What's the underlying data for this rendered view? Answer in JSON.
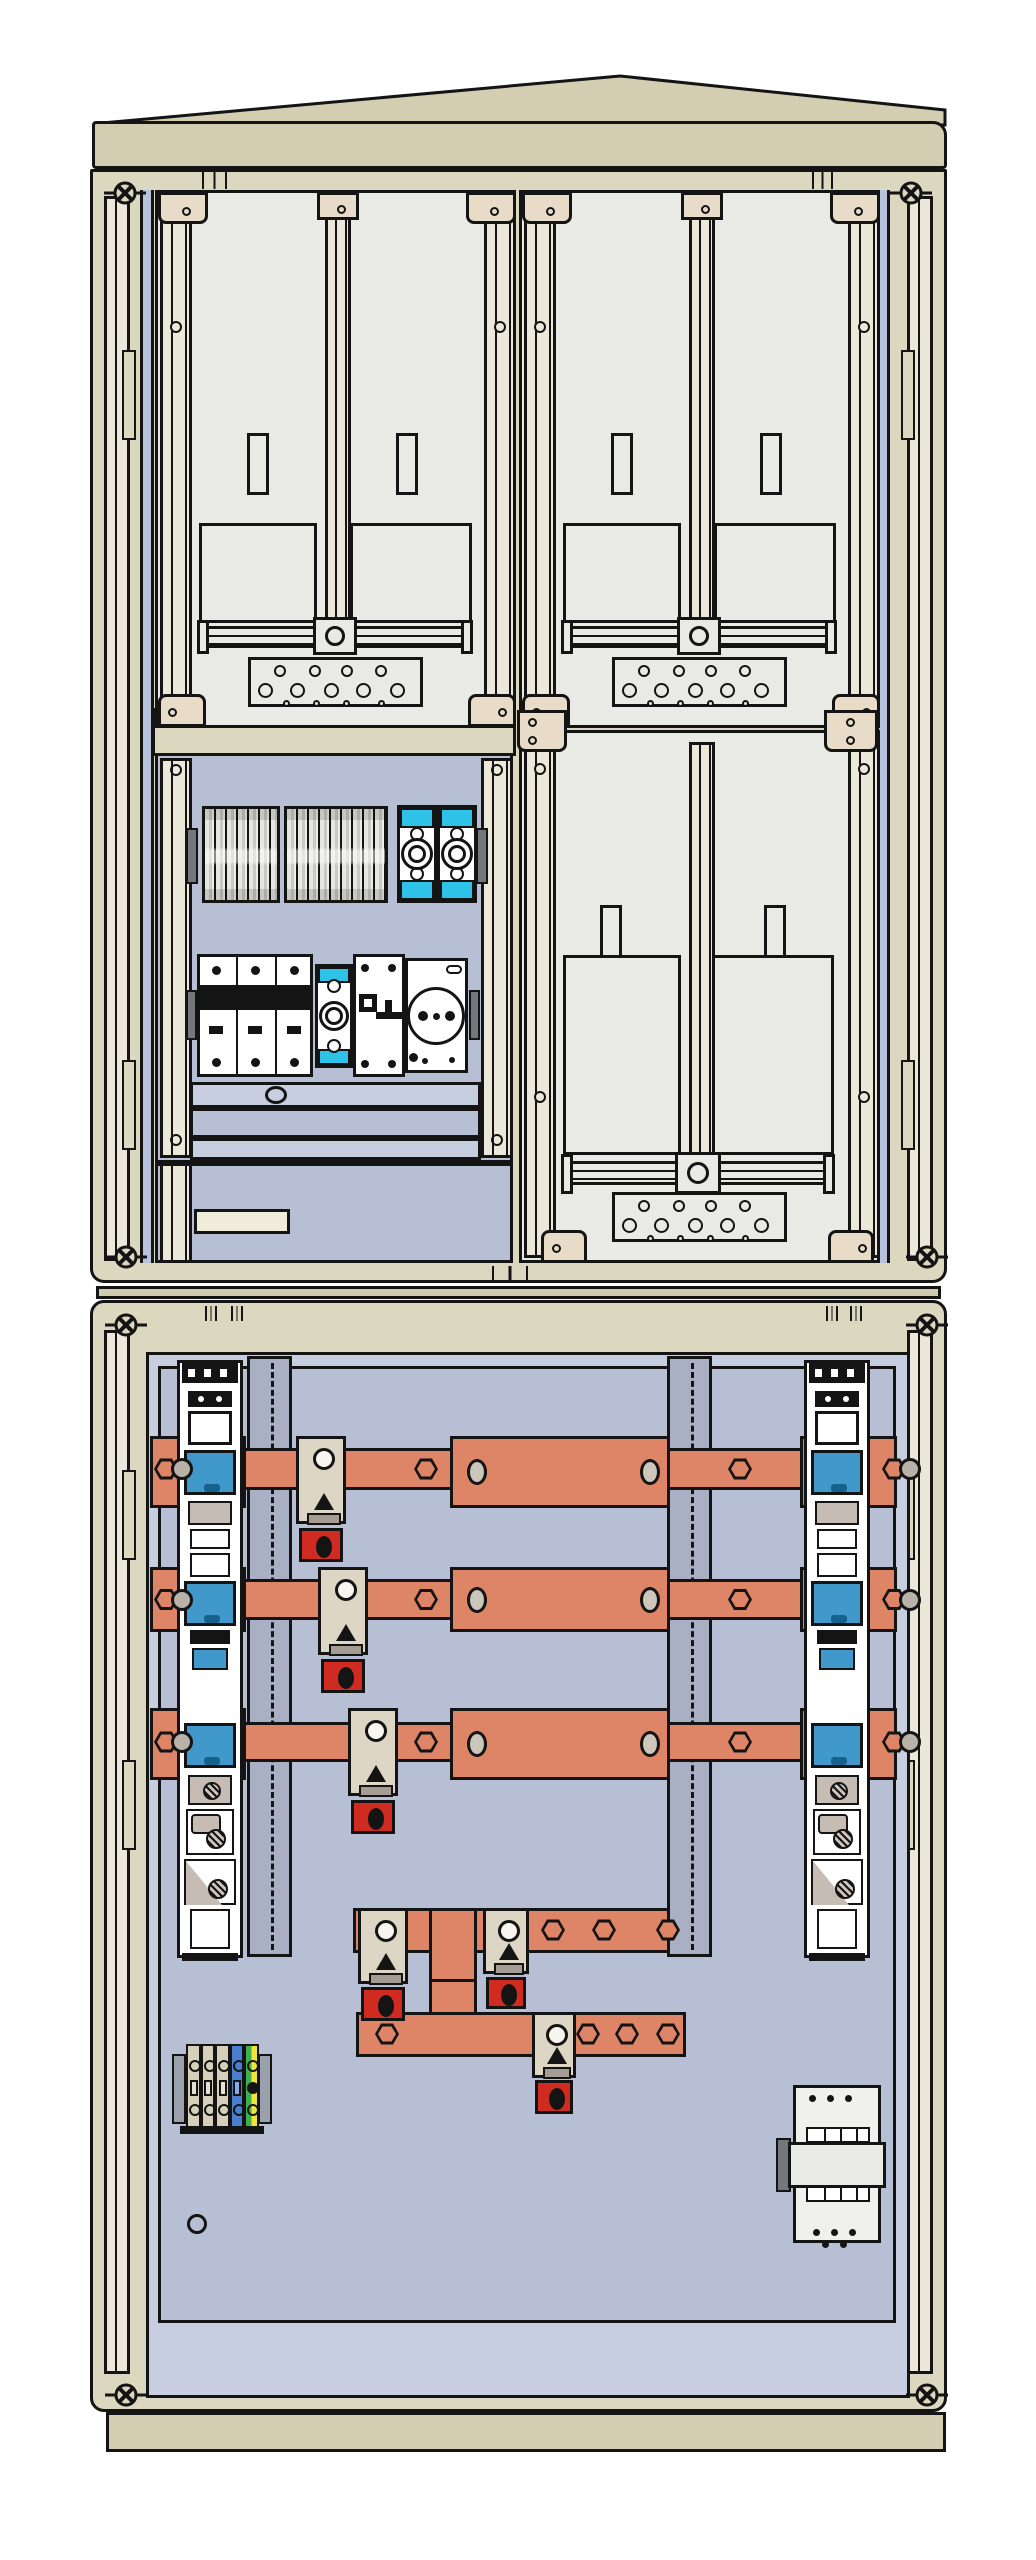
{
  "document": {
    "type": "technical-illustration",
    "subject": "outdoor cable distribution and meter cabinet, front view, doors open",
    "sections": [
      "upper enclosure with two meter fields, distribution device field and lower-right meter field",
      "lower enclosure with busbar system, NH fuse strips, terminal block and main switch"
    ]
  },
  "colors": {
    "ink": "#141414",
    "background": "#ffffff",
    "roof_beige": "#d3ceb2",
    "wall_beige": "#dcd8c0",
    "junction_beige": "#d0ccb0",
    "cream_rail": "#ece8d9",
    "bracket_cream": "#e8dcc9",
    "meter_panel": "#e9e9e5",
    "mounting_plate": "#b6bfd3",
    "door_inner": "#c6cedf",
    "cable_rail_gray": "#a9b0c4",
    "duct_light": "#c6cedf",
    "copper_busbar": "#dd8566",
    "oval_hole": "#cdc6bb",
    "nut_gray": "#b9b2a9",
    "fuse_blue": "#4198cb",
    "fuse_blue_dark": "#16628f",
    "cyan_band": "#2fc2e9",
    "clamp_beige": "#ddd6c4",
    "clamp_taupe": "#c7bcb4",
    "red_sleeve": "#cf2b20",
    "rail_end_gray": "#74787d",
    "terminal_beige": "#d6d0ba",
    "terminal_blue": "#4a7fd0",
    "terminal_green": "#3fae4e",
    "terminal_yellow": "#f0e437",
    "device_white": "#f0f0ed"
  },
  "meter_fields": [
    {
      "name": "meter-field-top-left",
      "panel": [
        155,
        190,
        361,
        538
      ],
      "rails": [
        [
          160,
          195,
          32,
          528
        ],
        [
          484,
          195,
          32,
          528
        ]
      ],
      "rail_screws": [
        [
          176,
          207
        ],
        [
          176,
          327
        ],
        [
          500,
          207
        ],
        [
          500,
          327
        ]
      ],
      "top_brackets": [
        [
          158,
          192,
          50,
          32
        ],
        [
          466,
          192,
          50,
          32
        ]
      ],
      "center_bar": [
        325,
        200,
        26,
        424
      ],
      "center_bracket": [
        317,
        192,
        42,
        28
      ],
      "slots": [
        [
          247,
          433
        ],
        [
          396,
          433
        ]
      ],
      "slot_size": [
        22,
        62
      ],
      "windows": [
        [
          199,
          523,
          118,
          100
        ],
        [
          350,
          523,
          122,
          100
        ]
      ],
      "hrail": {
        "bar": [
          199,
          626,
          274,
          22
        ],
        "caps": [
          [
            197,
            620,
            12,
            34
          ],
          [
            461,
            620,
            12,
            34
          ]
        ],
        "block": [
          313,
          617,
          44,
          38
        ],
        "circle": [
          335,
          636,
          10
        ]
      },
      "plate": [
        248,
        657
      ],
      "bottom_brackets": [
        [
          158,
          694,
          48,
          33
        ],
        [
          468,
          694,
          48,
          33
        ]
      ],
      "bottom_holes": [
        [
          172,
          712
        ],
        [
          502,
          712
        ]
      ]
    },
    {
      "name": "meter-field-top-right",
      "panel": [
        519,
        190,
        361,
        538
      ],
      "rails": [
        [
          524,
          195,
          32,
          528
        ],
        [
          848,
          195,
          32,
          528
        ]
      ],
      "rail_screws": [
        [
          540,
          207
        ],
        [
          540,
          327
        ],
        [
          864,
          207
        ],
        [
          864,
          327
        ]
      ],
      "top_brackets": [
        [
          522,
          192,
          50,
          32
        ],
        [
          830,
          192,
          50,
          32
        ]
      ],
      "center_bar": [
        689,
        200,
        26,
        424
      ],
      "center_bracket": [
        681,
        192,
        42,
        28
      ],
      "slots": [
        [
          611,
          433
        ],
        [
          760,
          433
        ]
      ],
      "slot_size": [
        22,
        62
      ],
      "windows": [
        [
          563,
          523,
          118,
          100
        ],
        [
          714,
          523,
          122,
          100
        ]
      ],
      "hrail": {
        "bar": [
          563,
          626,
          274,
          22
        ],
        "caps": [
          [
            561,
            620,
            12,
            34
          ],
          [
            825,
            620,
            12,
            34
          ]
        ],
        "block": [
          677,
          617,
          44,
          38
        ],
        "circle": [
          699,
          636,
          10
        ]
      },
      "plate": [
        612,
        657
      ],
      "bottom_brackets": [
        [
          522,
          694,
          48,
          33
        ],
        [
          832,
          694,
          48,
          33
        ]
      ],
      "bottom_holes": [
        [
          536,
          712
        ],
        [
          866,
          712
        ]
      ]
    },
    {
      "name": "meter-field-bottom-right",
      "panel": [
        519,
        730,
        361,
        533
      ],
      "rails": [
        [
          524,
          735,
          32,
          523
        ],
        [
          848,
          735,
          32,
          523
        ]
      ],
      "rail_screws": [
        [
          540,
          769
        ],
        [
          540,
          1097
        ],
        [
          864,
          769
        ],
        [
          864,
          1097
        ]
      ],
      "top_brackets": [
        [
          517,
          710,
          50,
          42
        ],
        [
          824,
          710,
          54,
          42
        ]
      ],
      "top_bracket_holes": [
        [
          532,
          722
        ],
        [
          532,
          740
        ],
        [
          850,
          722
        ],
        [
          850,
          740
        ]
      ],
      "center_bar": [
        689,
        742,
        26,
        416
      ],
      "center_bracket": null,
      "slots": [
        [
          600,
          905
        ],
        [
          764,
          905
        ]
      ],
      "slot_size": [
        22,
        62
      ],
      "windows": [
        [
          563,
          955,
          118,
          200
        ],
        [
          712,
          955,
          122,
          200
        ]
      ],
      "hrail": {
        "bar": [
          563,
          1161,
          272,
          24
        ],
        "caps": [
          [
            561,
            1154,
            12,
            40
          ],
          [
            823,
            1154,
            12,
            40
          ]
        ],
        "block": [
          675,
          1152,
          46,
          42
        ],
        "circle": [
          698,
          1173,
          11
        ]
      },
      "plate": [
        612,
        1192
      ],
      "bottom_brackets": [
        [
          541,
          1230,
          46,
          33
        ],
        [
          828,
          1230,
          46,
          33
        ]
      ],
      "bottom_holes": [
        [
          556,
          1248
        ],
        [
          862,
          1248
        ]
      ]
    }
  ],
  "perforated_plate": {
    "w": 175,
    "h": 50,
    "rows": [
      {
        "dy": 11,
        "r": 6,
        "xs": [
          29,
          64,
          96,
          130
        ]
      },
      {
        "dy": 30,
        "r": 7.5,
        "xs": [
          14,
          46,
          80,
          112,
          146
        ]
      },
      {
        "dy": 43,
        "r": 3.5,
        "xs": [
          35,
          65,
          95,
          130
        ]
      }
    ]
  },
  "busbars": {
    "span_x": [
      150,
      897
    ],
    "wide_x": [
      450,
      220
    ],
    "pad_left": [
      150,
      96
    ],
    "pad_right": [
      800,
      97
    ],
    "hex_x": [
      426,
      740
    ],
    "oval_x": [
      477,
      650
    ],
    "bars": [
      {
        "name": "busbar-L1",
        "wide_y": 1436,
        "wide_h": 72,
        "narrow_y": 1448,
        "narrow_h": 42,
        "clamp_x": 296
      },
      {
        "name": "busbar-L2",
        "wide_y": 1567,
        "wide_h": 65,
        "narrow_y": 1579,
        "narrow_h": 41,
        "clamp_x": 318
      },
      {
        "name": "busbar-L3",
        "wide_y": 1708,
        "wide_h": 72,
        "narrow_y": 1722,
        "narrow_h": 40,
        "clamp_x": 348
      }
    ]
  },
  "fuse_strips": {
    "xs": [
      177,
      804
    ],
    "w": 66,
    "y": 1360,
    "h": 598,
    "blue_windows_y": [
      87,
      218,
      360
    ],
    "names": [
      "nh-fuse-strip-left",
      "nh-fuse-strip-right"
    ]
  },
  "cable_rails": [
    [
      247,
      1356,
      45,
      601
    ],
    [
      667,
      1356,
      45,
      601
    ]
  ],
  "lower_assembly": {
    "upper_bar": [
      353,
      1908,
      333,
      45
    ],
    "vertical_bar": [
      429,
      1908,
      48,
      148
    ],
    "lower_bar": [
      356,
      2012,
      330,
      45
    ],
    "hexes_upper": [
      553,
      604,
      668
    ],
    "hexes_lower": [
      387,
      588,
      627,
      668
    ],
    "clamps": [
      {
        "x": 358,
        "w": 50,
        "top": 1908,
        "beigeH": 76,
        "redY": 1987,
        "redH": 34
      },
      {
        "x": 483,
        "w": 46,
        "top": 1908,
        "beigeH": 66,
        "redY": 1977,
        "redH": 32
      },
      {
        "x": 532,
        "w": 44,
        "top": 2012,
        "beigeH": 66,
        "redY": 2080,
        "redH": 34
      }
    ]
  },
  "terminal_block": {
    "x": 172,
    "y": 2042,
    "w": 100,
    "h": 92,
    "terminal_colors": [
      "beige",
      "beige",
      "beige",
      "blue",
      "green-yellow"
    ]
  },
  "main_switch_device": {
    "body": [
      793,
      2085,
      88,
      158
    ],
    "clip": [
      776,
      2138,
      15,
      54
    ],
    "mid_band": [
      788,
      2142,
      98,
      46
    ],
    "top_dots": [
      [
        812,
        2094
      ],
      [
        830,
        2094
      ],
      [
        848,
        2094
      ]
    ],
    "bottom_dots": [
      [
        816,
        2228
      ],
      [
        834,
        2228
      ],
      [
        852,
        2228
      ],
      [
        825,
        2240
      ],
      [
        843,
        2240
      ]
    ],
    "terminal_rows": [
      [
        806,
        2127,
        64,
        16
      ],
      [
        806,
        2186,
        64,
        16
      ]
    ]
  },
  "screws_x": [
    [
      125,
      193
    ],
    [
      911,
      193
    ],
    [
      126,
      1257
    ],
    [
      927,
      1257
    ],
    [
      126,
      1325
    ],
    [
      927,
      1325
    ],
    [
      126,
      2395
    ],
    [
      927,
      2395
    ]
  ],
  "hinge_tabs": [
    [
      202,
      171,
      25,
      18
    ],
    [
      812,
      171,
      21,
      18
    ],
    [
      492,
      1266,
      36,
      15
    ],
    [
      205,
      1306,
      12,
      15
    ],
    [
      231,
      1306,
      12,
      15
    ],
    [
      826,
      1306,
      12,
      15
    ],
    [
      850,
      1306,
      12,
      15
    ]
  ],
  "misc": {
    "label_plate": [
      194,
      1209,
      96,
      25
    ],
    "drain_hole": [
      187,
      2214,
      20,
      20
    ]
  }
}
